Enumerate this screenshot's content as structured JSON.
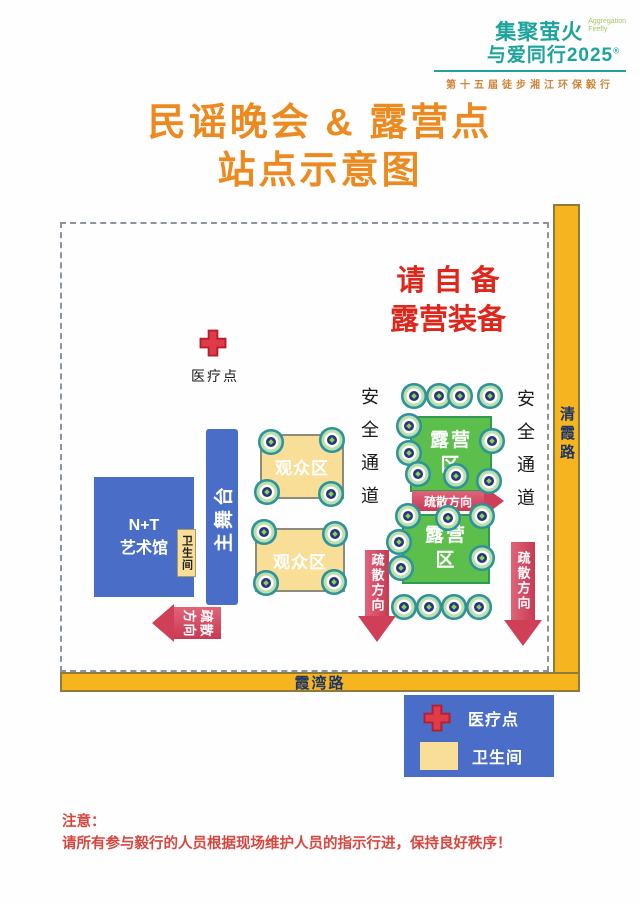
{
  "logo": {
    "brand_top": "集聚萤火",
    "brand_bottom": "与爱同行2025",
    "brand_reg": "®",
    "brand_en_1": "Aggregation",
    "brand_en_2": "Firefly",
    "event_name": "第十五届徒步湘江环保毅行"
  },
  "title": {
    "line1": "民谣晚会 & 露营点",
    "line2": "站点示意图"
  },
  "map": {
    "notice": {
      "line1": "请 自 备",
      "line2": "露营装备"
    },
    "medical_point_label": "医疗点",
    "art_gallery": {
      "line1": "N+T",
      "line2": "艺术馆"
    },
    "toilet_label": "卫生间",
    "main_stage_label": "主舞台",
    "audience_area_label": "观众区",
    "camping_area": {
      "line1": "露营",
      "line2": "区"
    },
    "safety_corridor_label": "安全通道",
    "evacuation_label": "疏散方向",
    "evacuation_chars": {
      "c1": "方",
      "c2": "向",
      "c3": "疏",
      "c4": "散"
    },
    "road_right_label": "清霞路",
    "road_bottom_label": "霞湾路"
  },
  "legend": {
    "medical_label": "医疗点",
    "toilet_label": "卫生间"
  },
  "note": {
    "line1": "注意：",
    "line2": "请所有参与毅行的人员根据现场维护人员的指示行进，保持良好秩序！"
  },
  "colors": {
    "title_orange": "#EC8A1F",
    "warning_red": "#E0261B",
    "zone_blue": "#4A6DC8",
    "zone_green": "#5CBE4B",
    "zone_yellow": "#F8DE96",
    "road_yellow": "#F6B51F",
    "arrow_red": "#CF4058",
    "brand_teal": "#1CA49C"
  }
}
